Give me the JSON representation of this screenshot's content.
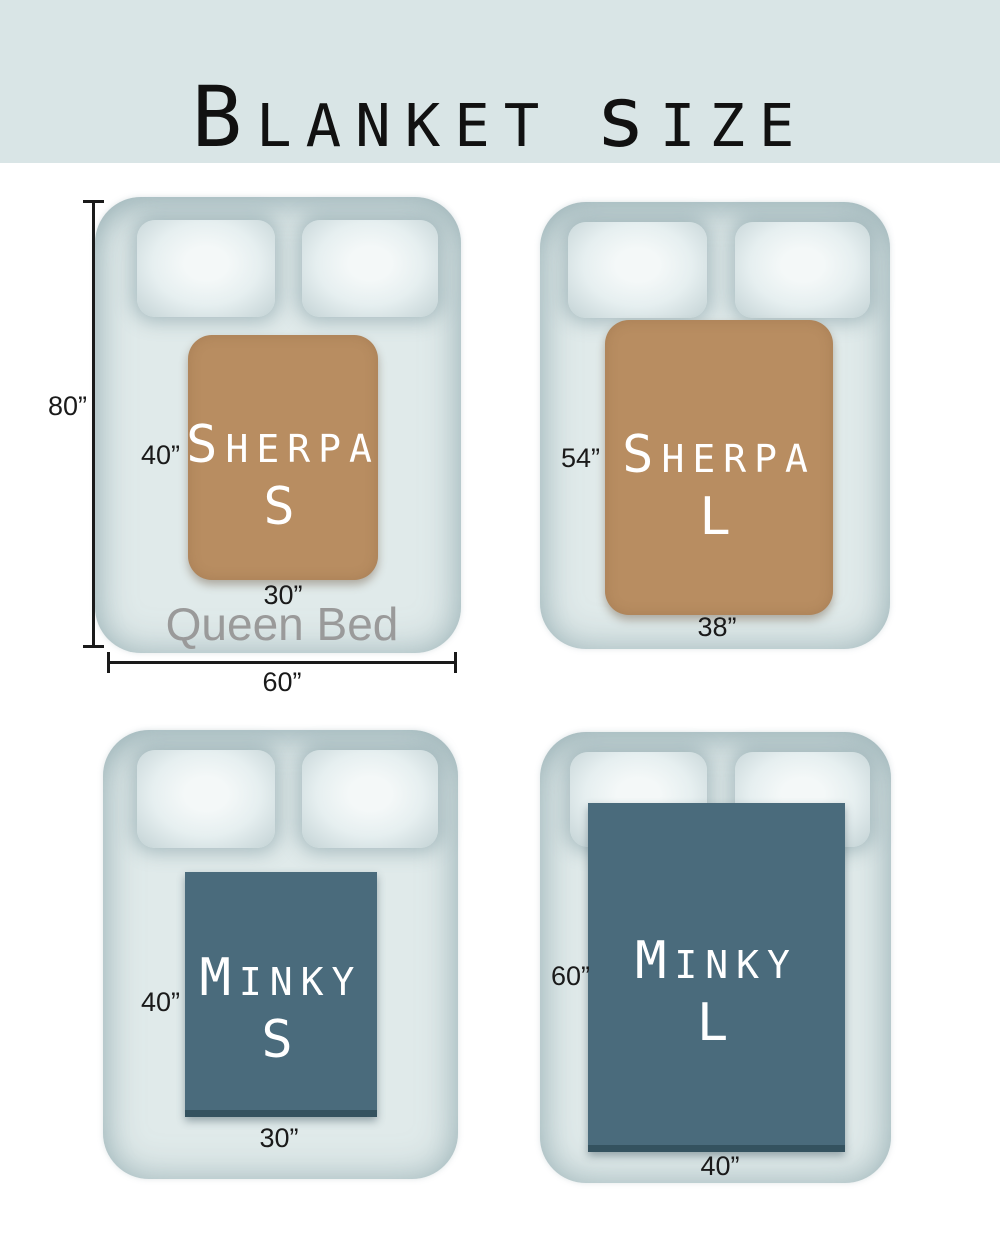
{
  "colors": {
    "header_bg": "#d9e5e6",
    "bed": "#e0eaea",
    "sherpa": "#b88d61",
    "minky": "#4a6b7c",
    "minky_edge": "#34525f",
    "dimension": "#1a1a1a",
    "bed_label": "#9a9a9a",
    "blanket_text": "#ffffff",
    "title_text": "#111111"
  },
  "title": {
    "lead1": "B",
    "rest1": "lanket",
    "lead2": "s",
    "rest2": "ize"
  },
  "bed": {
    "name": "Queen Bed",
    "height_label": "80”",
    "width_label": "60”"
  },
  "diagrams": [
    {
      "product": "Sherpa S",
      "product_lead": "S",
      "product_rest": "herpa",
      "size_letter": "S",
      "blanket_height": "40”",
      "blanket_width": "30”"
    },
    {
      "product": "Sherpa L",
      "product_lead": "S",
      "product_rest": "herpa",
      "size_letter": "L",
      "blanket_height": "54”",
      "blanket_width": "38”"
    },
    {
      "product": "Minky S",
      "product_lead": "M",
      "product_rest": "inky",
      "size_letter": "S",
      "blanket_height": "40”",
      "blanket_width": "30”"
    },
    {
      "product": "Minky L",
      "product_lead": "M",
      "product_rest": "inky",
      "size_letter": "L",
      "blanket_height": "60”",
      "blanket_width": "40”"
    }
  ]
}
